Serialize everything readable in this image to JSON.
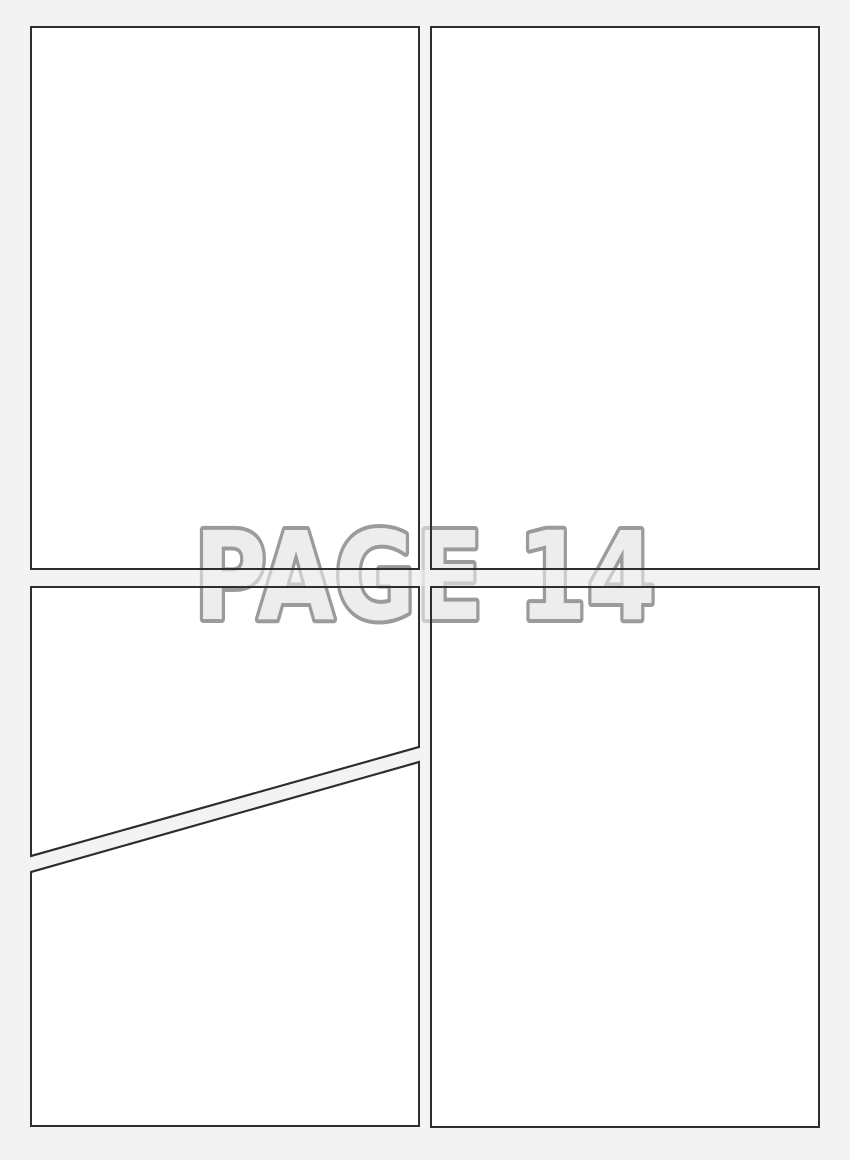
{
  "page": {
    "label": "PAGE 14",
    "panel_count": 5,
    "description": "blank comic book page template, 2x2 grid with diagonally split bottom-left panel"
  },
  "colors": {
    "bg": "#f3f3f4",
    "panel_fill": "#ffffff",
    "line": "#2e2e30",
    "label_fill": "#ededed",
    "label_outline": "#9b9b9b",
    "gutter_wash": "rgba(243,243,244,0.55)"
  }
}
